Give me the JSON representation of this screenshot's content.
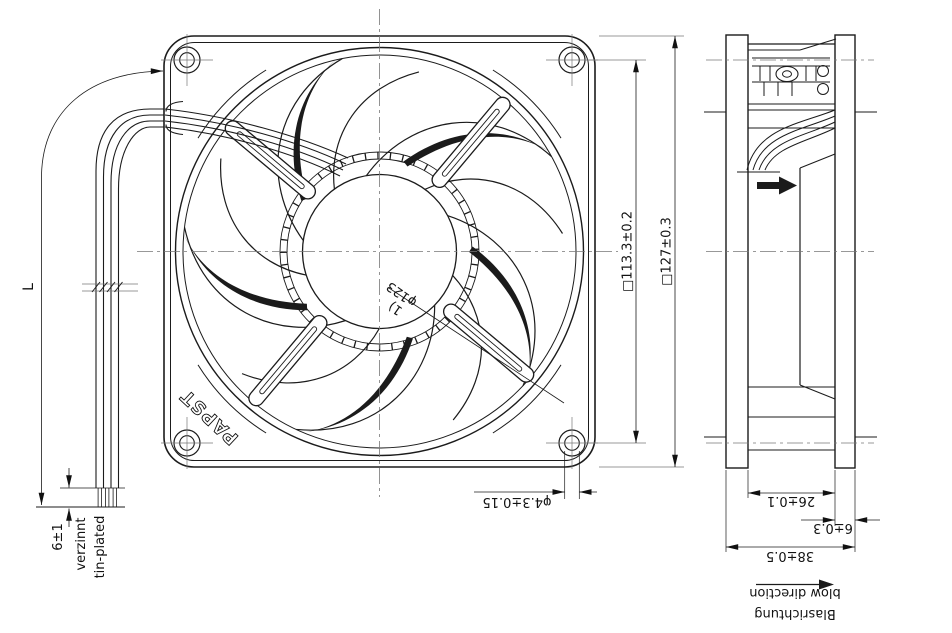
{
  "front_view": {
    "logo": "PAPST",
    "dims": {
      "hole_spacing": "□113.3±0.2",
      "frame_size": "□127±0.3",
      "hole_diameter": "φ4.3±0.15",
      "ring_diameter": "φ123",
      "ring_footnote": "1)",
      "lead_length": "L",
      "tinned_length": "6±1"
    },
    "lead_finish_de": "verzinnt",
    "lead_finish_en": "tin-plated"
  },
  "side_view": {
    "dims": {
      "depth": "38±0.5",
      "flange_thickness": "6±0.3",
      "housing_width": "26±0.1"
    },
    "blow_direction_de": "Blasrichtung",
    "blow_direction_en": "blow direction"
  },
  "colors": {
    "line": "#1b1b1b",
    "centerline": "#777777",
    "background": "#ffffff"
  }
}
